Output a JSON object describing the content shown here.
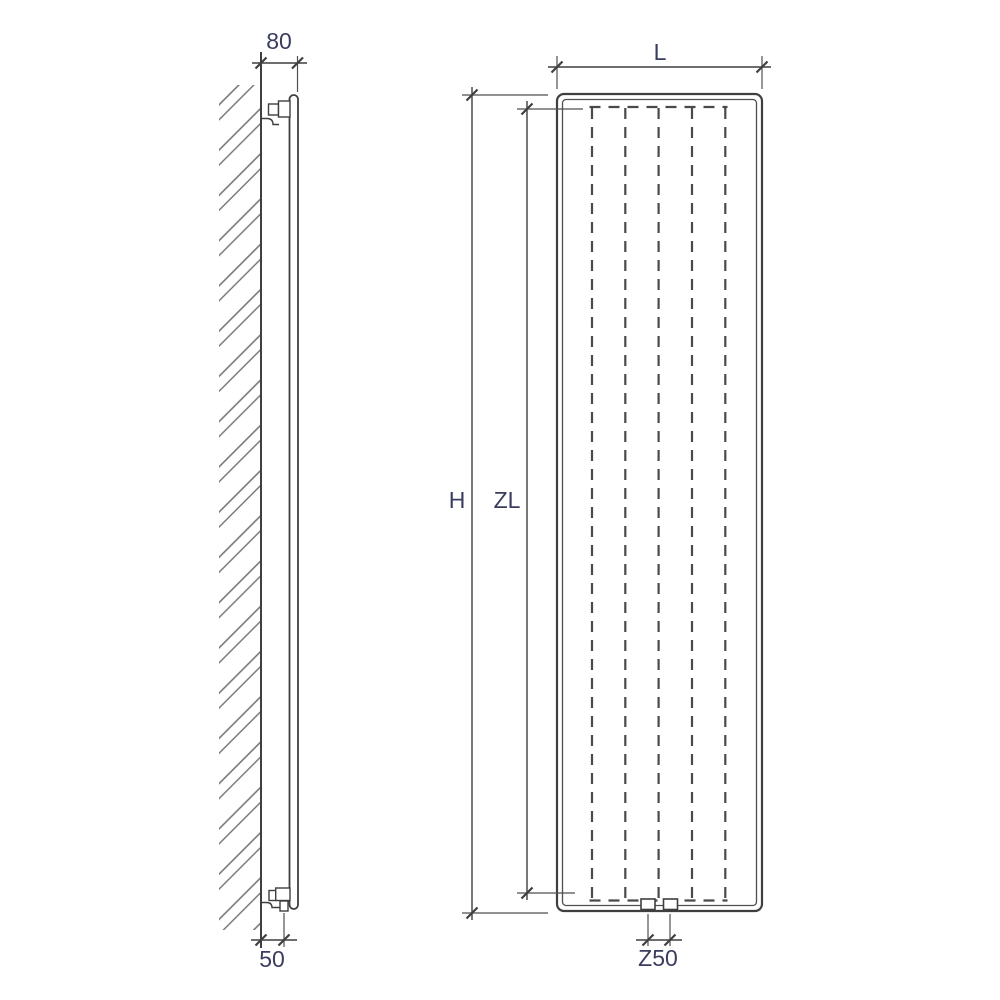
{
  "diagram": {
    "description": "Vertical radiator technical drawing, side view and front view with dimension lines",
    "side_view": {
      "dim_top_offset": "80",
      "dim_bottom_offset": "50"
    },
    "front_view": {
      "dim_width": "L",
      "dim_height": "H",
      "dim_axle_height": "ZL",
      "dim_connection_spacing": "Z50"
    },
    "colors": {
      "line": "#3f3f3f",
      "extension_line": "#4f4f4f",
      "dashed_channel": "#4a4a4a",
      "label_text": "#3a3d5f",
      "hatch": "#707070",
      "background": "#ffffff"
    }
  }
}
